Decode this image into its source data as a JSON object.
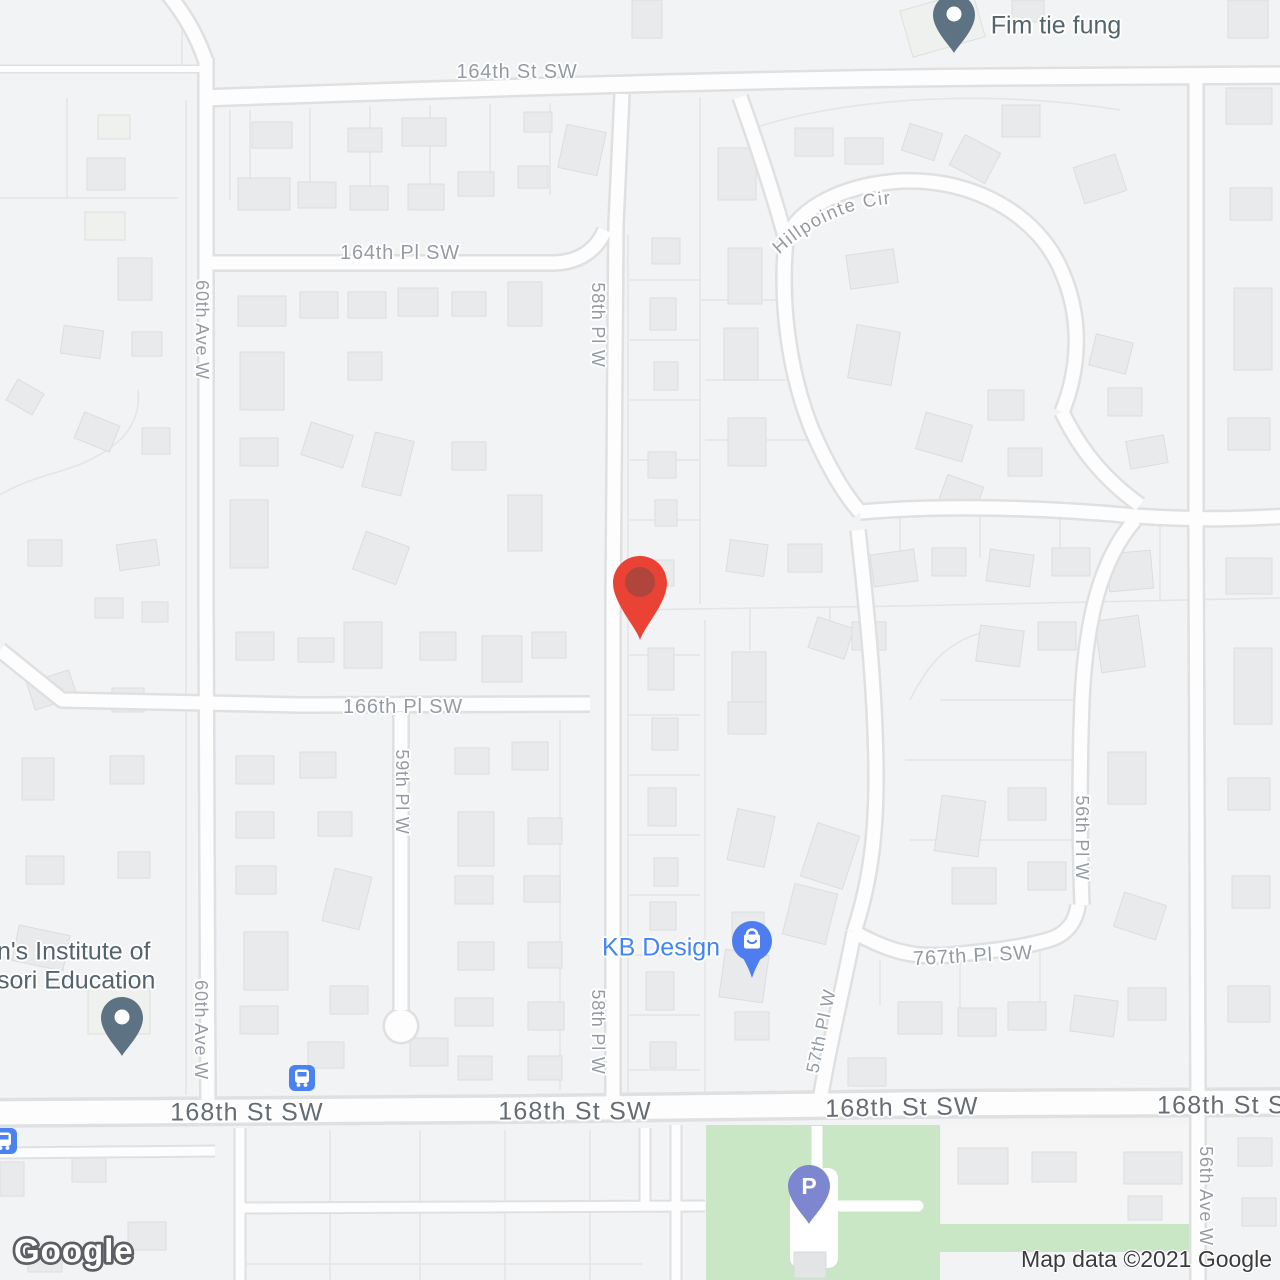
{
  "map": {
    "attribution": "Map data ©2021 Google",
    "logo": "Google"
  },
  "streets": {
    "st_164": "164th St SW",
    "pl_164": "164th Pl SW",
    "pl_58": "58th Pl W",
    "hillpointe": "Hillpointe Cir",
    "ave_60": "60th Ave W",
    "pl_166": "166th Pl SW",
    "pl_59": "59th Pl W",
    "pl_57": "57th Pl W",
    "pl_767": "767th Pl SW",
    "pl_56": "56th Pl W",
    "ave_56": "56th Ave W",
    "st_168": "168th St SW"
  },
  "pois": {
    "fim_tie_fung": {
      "label": "Fim tie fung",
      "icon": "place-pin"
    },
    "kb_design": {
      "label": "KB Design",
      "icon": "shopping-bag-pin"
    },
    "institute": {
      "label_line1": "n's Institute of",
      "label_line2": "sori Education",
      "icon": "place-pin"
    },
    "parking": {
      "letter": "P",
      "icon": "parking-pin"
    },
    "bus_stop": {
      "icon": "bus-stop"
    },
    "dropped_marker": {
      "icon": "red-map-pin"
    }
  },
  "colors": {
    "marker_red": "#EA4335",
    "marker_red_inner": "#B0463B",
    "poi_pin_slate": "#5D7384",
    "poi_label": "#54646F",
    "kb_blue_label": "#4285F4",
    "shopping_pin_blue": "#4D7DEE",
    "bus_blue": "#4A82F0",
    "parking_indigo": "#7C87CF",
    "park_green": "#C9E7C5",
    "road_white": "#FDFDFE",
    "background": "#F2F3F4",
    "building": "#E9EAEC",
    "street_label": "#949BA4",
    "main_road_label": "#656C73"
  }
}
